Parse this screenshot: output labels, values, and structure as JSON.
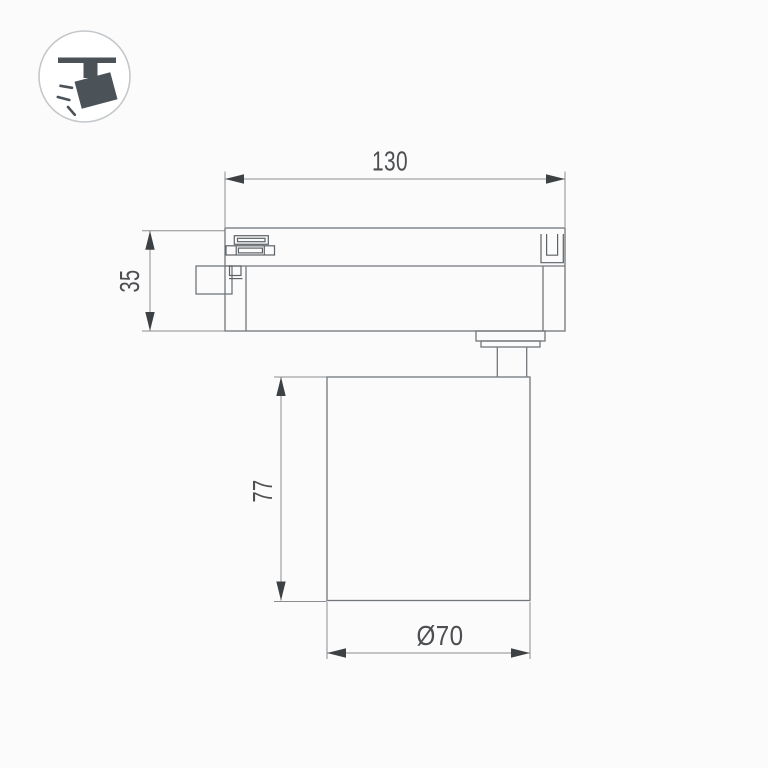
{
  "page": {
    "background": "#fbfbfb",
    "description": "Technical dimension drawing of track-mounted cylindrical spotlight, side view"
  },
  "icon": {
    "semantic": "ceiling-track-spotlight-icon",
    "fill_color": "#4b5258",
    "circle_border": "#c4c8cb",
    "circle_fill": "#ffffff"
  },
  "drawing": {
    "labels": {
      "length": "130",
      "adapter_height": "35",
      "body_height": "77",
      "diameter": "Ø70"
    },
    "colors": {
      "object_line": "#73777b",
      "detail_line": "#5d6266",
      "dim_line": "#8a8d90",
      "arrow": "#3e4144",
      "text": "#4c4e51"
    }
  }
}
